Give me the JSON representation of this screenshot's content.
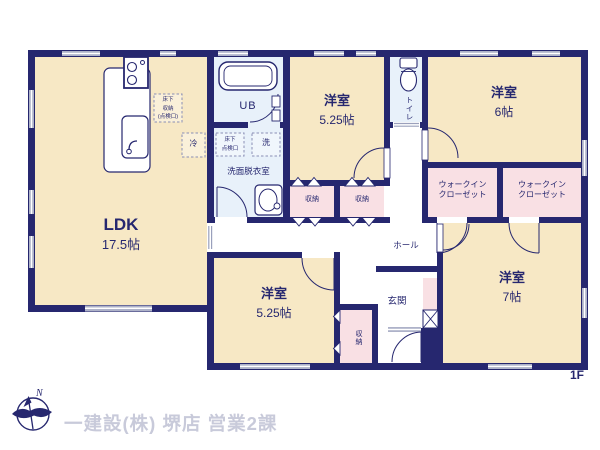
{
  "rooms": {
    "ldk": {
      "label": "LDK",
      "area": "17.5帖"
    },
    "western_top": {
      "label": "洋室",
      "area": "5.25帖"
    },
    "western_right_top": {
      "label": "洋室",
      "area": "6帖"
    },
    "western_bottom": {
      "label": "洋室",
      "area": "5.25帖"
    },
    "western_right_bottom": {
      "label": "洋室",
      "area": "7帖"
    },
    "unit_bath": {
      "label": "UB"
    },
    "toilet": {
      "label": "トイレ"
    },
    "washroom": {
      "label": "洗面脱衣室"
    },
    "hall": {
      "label": "ホール"
    },
    "entrance": {
      "label": "玄関"
    },
    "wic_left": {
      "line1": "ウォークイン",
      "line2": "クローゼット"
    },
    "wic_right": {
      "line1": "ウォークイン",
      "line2": "クローゼット"
    },
    "storage_center_left": {
      "label": "収納"
    },
    "storage_center_right": {
      "label": "収納"
    },
    "storage_entrance": {
      "label": "収納"
    }
  },
  "annotations": {
    "underfloor_storage": {
      "line1": "床下",
      "line2": "収納",
      "line3": "(点検口)"
    },
    "underfloor_access": {
      "line1": "床下",
      "line2": "点検口"
    },
    "refrigerator": "冷",
    "washer": "洗"
  },
  "footer": {
    "company": "一建設(株) 堺店 営業2課",
    "compass_label": "N",
    "floor_label": "1F"
  },
  "colors": {
    "wall": "#26276F",
    "room_cream": "#F7E8C5",
    "room_pink": "#F9E0E4",
    "room_blue": "#E8F1FA",
    "window_gray": "#AEB2C9",
    "footer_text": "#C8CADA"
  }
}
